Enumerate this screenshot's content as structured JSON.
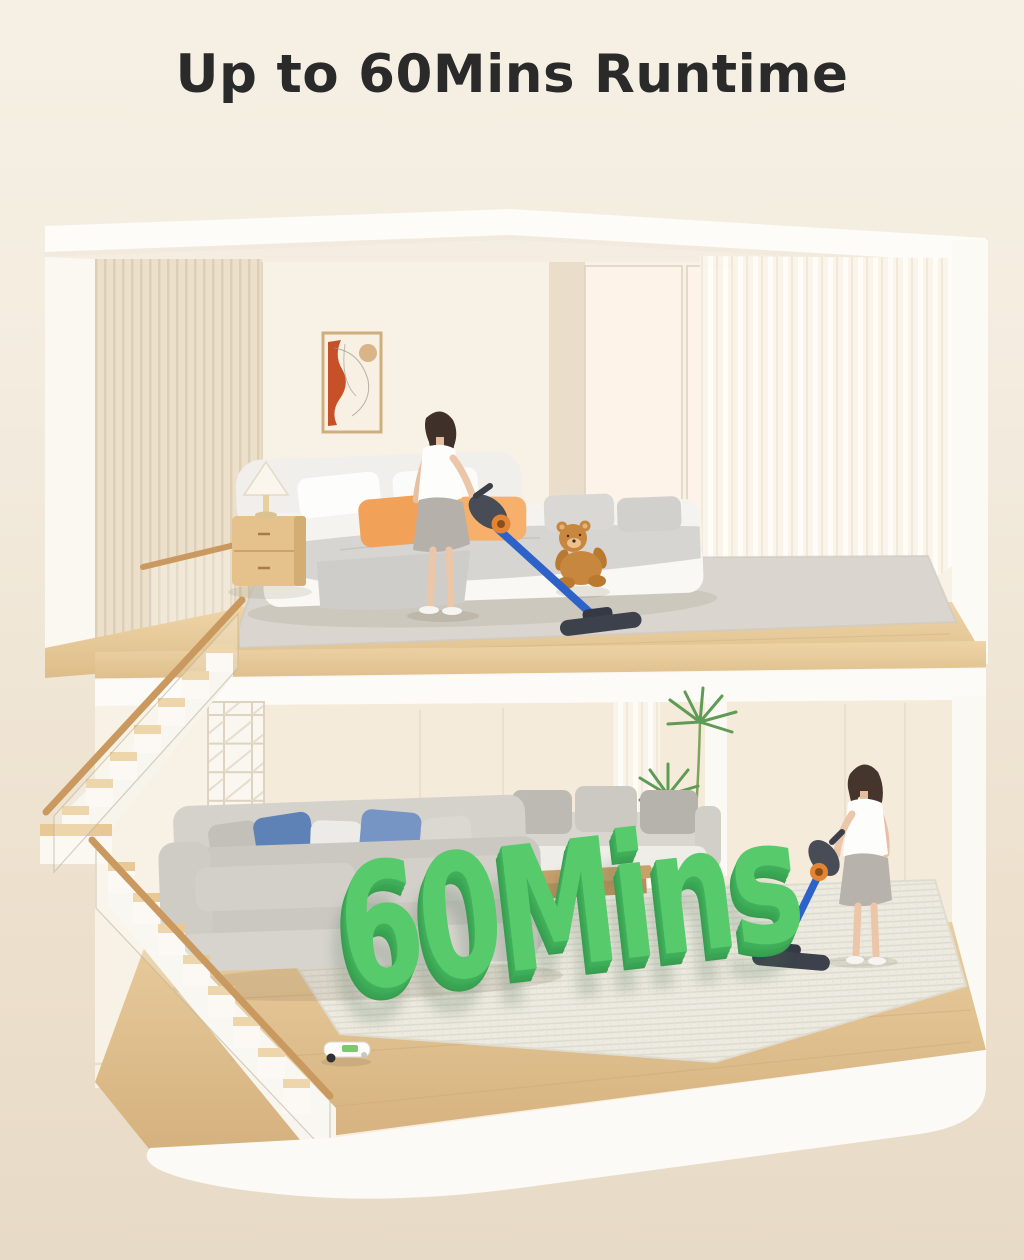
{
  "header": {
    "title": "Up to 60Mins Runtime"
  },
  "scene": {
    "runtime_label": {
      "text": "60Mins",
      "face_color": "#57ca6c",
      "side_color": "#3aa053"
    },
    "palette": {
      "background_top": "#f6f0e4",
      "background_bottom": "#e7dac6",
      "title_color": "#2a2a2a",
      "wall_cream": "#f8f1e5",
      "structure_white": "#fcfaf5",
      "wood_floor": "#e2c391",
      "rug_gray": "#dad6cf",
      "rug_woven": "#edebe1",
      "sofa_gray": "#cdcac4",
      "pillow_blue": "#5f82b6",
      "pillow_blue_light": "#7695c5",
      "pillow_orange": "#f2a159",
      "vacuum_tube_blue": "#2d63c9",
      "vacuum_body_dark": "#474c57",
      "vacuum_accent_orange": "#e28433",
      "teddy_brown": "#c8873e",
      "plant_green": "#5f9b54",
      "handrail_wood": "#c9995f"
    }
  }
}
